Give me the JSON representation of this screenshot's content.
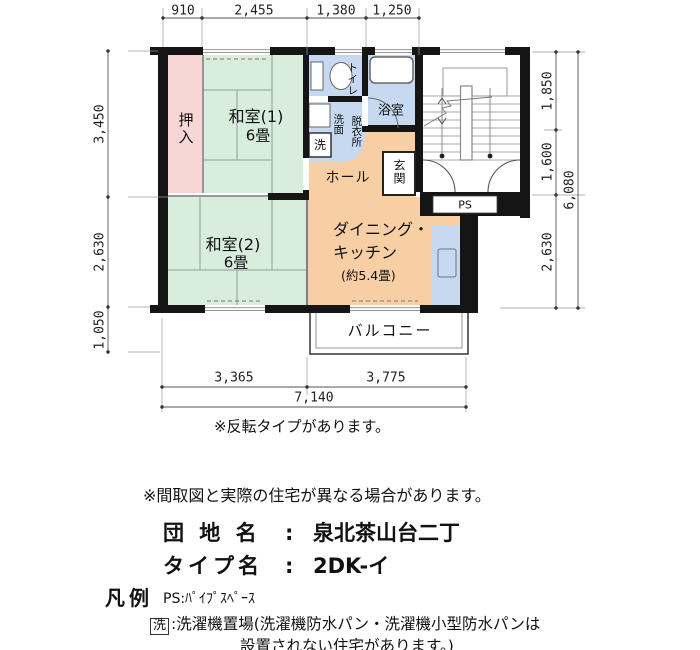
{
  "colors": {
    "wall": "#151515",
    "tatami_green": "#d9eddd",
    "closet_pink": "#f8d6d6",
    "wet_area_blue": "#c6d9f0",
    "living_orange": "#f8cfa4"
  },
  "dimensions": {
    "top": [
      "910",
      "2,455",
      "1,380",
      "1,250"
    ],
    "left": [
      "3,450",
      "2,630",
      "1,050"
    ],
    "right": [
      "1,850",
      "1,600",
      "2,630"
    ],
    "right_total": "6,080",
    "bottom": [
      "3,365",
      "3,775"
    ],
    "bottom_total": "7,140"
  },
  "rooms": {
    "oshiire": "押入",
    "washitsu1": "和室(1)",
    "washitsu1_size": "6畳",
    "washitsu2": "和室(2)",
    "washitsu2_size": "6畳",
    "toilet": "トイレ",
    "bath": "浴室",
    "senmen": "洗面",
    "datsui": "脱衣所",
    "wash": "洗",
    "hall": "ホール",
    "genkan": "玄関",
    "ps": "PS",
    "dk_line1": "ダイニング・",
    "dk_line2": "キッチン",
    "dk_size": "(約5.4畳)",
    "balcony": "バルコニー"
  },
  "notes": {
    "flip": "※反転タイプがあります。",
    "disclaimer": "※間取図と実際の住宅が異なる場合があります。"
  },
  "info": {
    "estate_label": "団 地 名",
    "colon": ":",
    "estate_name": "泉北茶山台二丁",
    "type_label": "タイプ名",
    "type_name": "2DK-イ"
  },
  "legend": {
    "title": "凡例",
    "ps": "PS:ﾊﾟｲﾌﾟｽﾍﾟｰｽ",
    "wash_symbol": "洗",
    "wash_line1": ":洗濯機置場(洗濯機防水パン・洗濯機小型防水パンは",
    "wash_line2": "設置されない住宅があります。)"
  }
}
